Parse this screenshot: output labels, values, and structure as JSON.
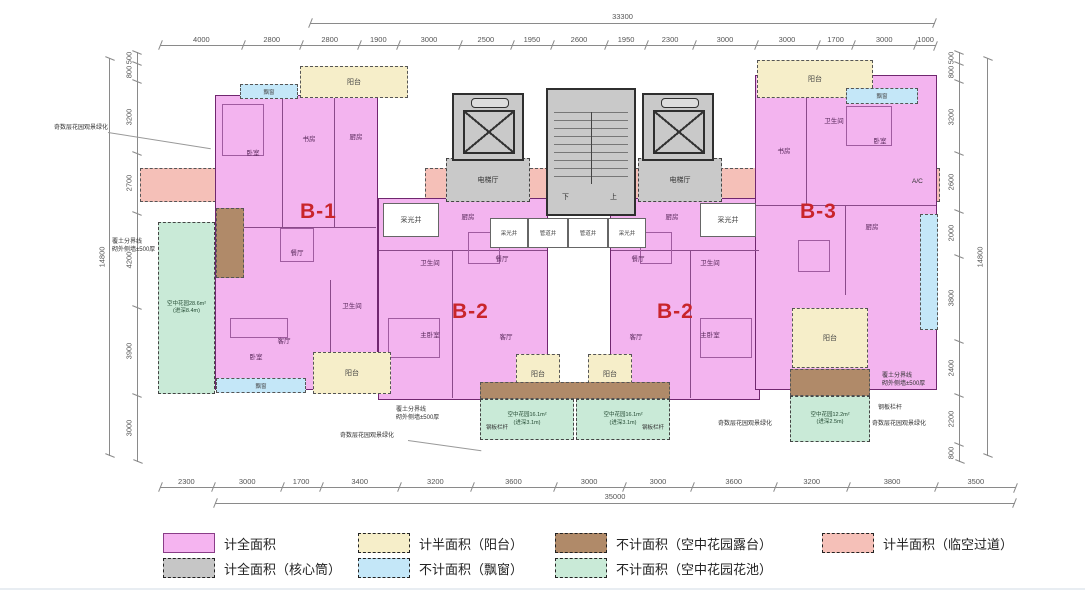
{
  "plan": {
    "zone_labels": {
      "balcony": "阳台",
      "baywindow": "飘窗"
    },
    "units": [
      {
        "label": "B-1",
        "rooms": [
          "卧室",
          "书房",
          "厨房",
          "餐厅",
          "客厅",
          "卫生间",
          "卧室"
        ]
      },
      {
        "label": "B-2",
        "rooms": [
          "厨房",
          "卫生间",
          "主卧室",
          "客厅",
          "餐厅"
        ]
      },
      {
        "label": "B-2",
        "rooms": [
          "厨房",
          "卫生间",
          "主卧室",
          "客厅",
          "餐厅"
        ]
      },
      {
        "label": "B-3",
        "rooms": [
          "书房",
          "卫生间",
          "卧室",
          "厨房",
          "客厅"
        ]
      }
    ],
    "core": {
      "elevator_hall": "电梯厅",
      "down": "下",
      "up": "上",
      "lightwell": "采光井",
      "duct": "管道井"
    },
    "gardens": [
      {
        "area": "空中花园28.6m²",
        "depth": "(进深8.4m)"
      },
      {
        "area": "空中花园16.1m²",
        "depth": "(进深3.1m)"
      },
      {
        "area": "空中花园16.1m²",
        "depth": "(进深3.1m)"
      },
      {
        "area": "空中花园12.2m²",
        "depth": "(进深2.5m)"
      }
    ],
    "annotations": {
      "soil_line": "覆土分界线",
      "outer_wall": "砌外侧墙±500厚",
      "greenery": "奇数层花园观景绿化",
      "railing": "钢板栏杆",
      "ac": "A/C"
    }
  },
  "dimensions": {
    "top": {
      "total": "33300",
      "segments": [
        "4000",
        "2800",
        "2800",
        "1900",
        "3000",
        "2500",
        "1950",
        "2600",
        "1950",
        "2300",
        "3000",
        "3000",
        "1700",
        "3000",
        "1000"
      ]
    },
    "bottom": {
      "total": "35000",
      "segments": [
        "2300",
        "3000",
        "1700",
        "3400",
        "3200",
        "3600",
        "3000",
        "3000",
        "3600",
        "3200",
        "3800",
        "3500"
      ]
    },
    "left": {
      "total": "14800",
      "segments": [
        "500",
        "800",
        "3200",
        "2700",
        "4200",
        "3900",
        "3000"
      ]
    },
    "right": {
      "total": "14800",
      "segments": [
        "500",
        "800",
        "3200",
        "2600",
        "2000",
        "3800",
        "2400",
        "2200",
        "800"
      ]
    }
  },
  "legend": {
    "items": [
      {
        "label": "计全面积",
        "color": "#f5b4f0",
        "dashed": false
      },
      {
        "label": "计全面积（核心筒）",
        "color": "#c6c6c6",
        "dashed": true
      },
      {
        "label": "计半面积（阳台）",
        "color": "#f6eec9",
        "dashed": true
      },
      {
        "label": "不计面积（飘窗）",
        "color": "#c4e7f8",
        "dashed": true
      },
      {
        "label": "不计面积（空中花园露台）",
        "color": "#b08a69",
        "dashed": true
      },
      {
        "label": "不计面积（空中花园花池）",
        "color": "#c9ead7",
        "dashed": true
      },
      {
        "label": "计半面积（临空过道）",
        "color": "#f5c0b8",
        "dashed": true
      }
    ]
  },
  "colors": {
    "unit_fill": "#f3b4ef",
    "unit_border": "#70276f",
    "unit_id_red": "#c9252b",
    "core_gray": "#c9c9c9",
    "corridor_salmon": "#f5c0b8",
    "balcony_cream": "#f6eec9",
    "baywindow_blue": "#c4e7f8",
    "garden_green": "#c9ead7",
    "terrace_brown": "#b08a69"
  }
}
